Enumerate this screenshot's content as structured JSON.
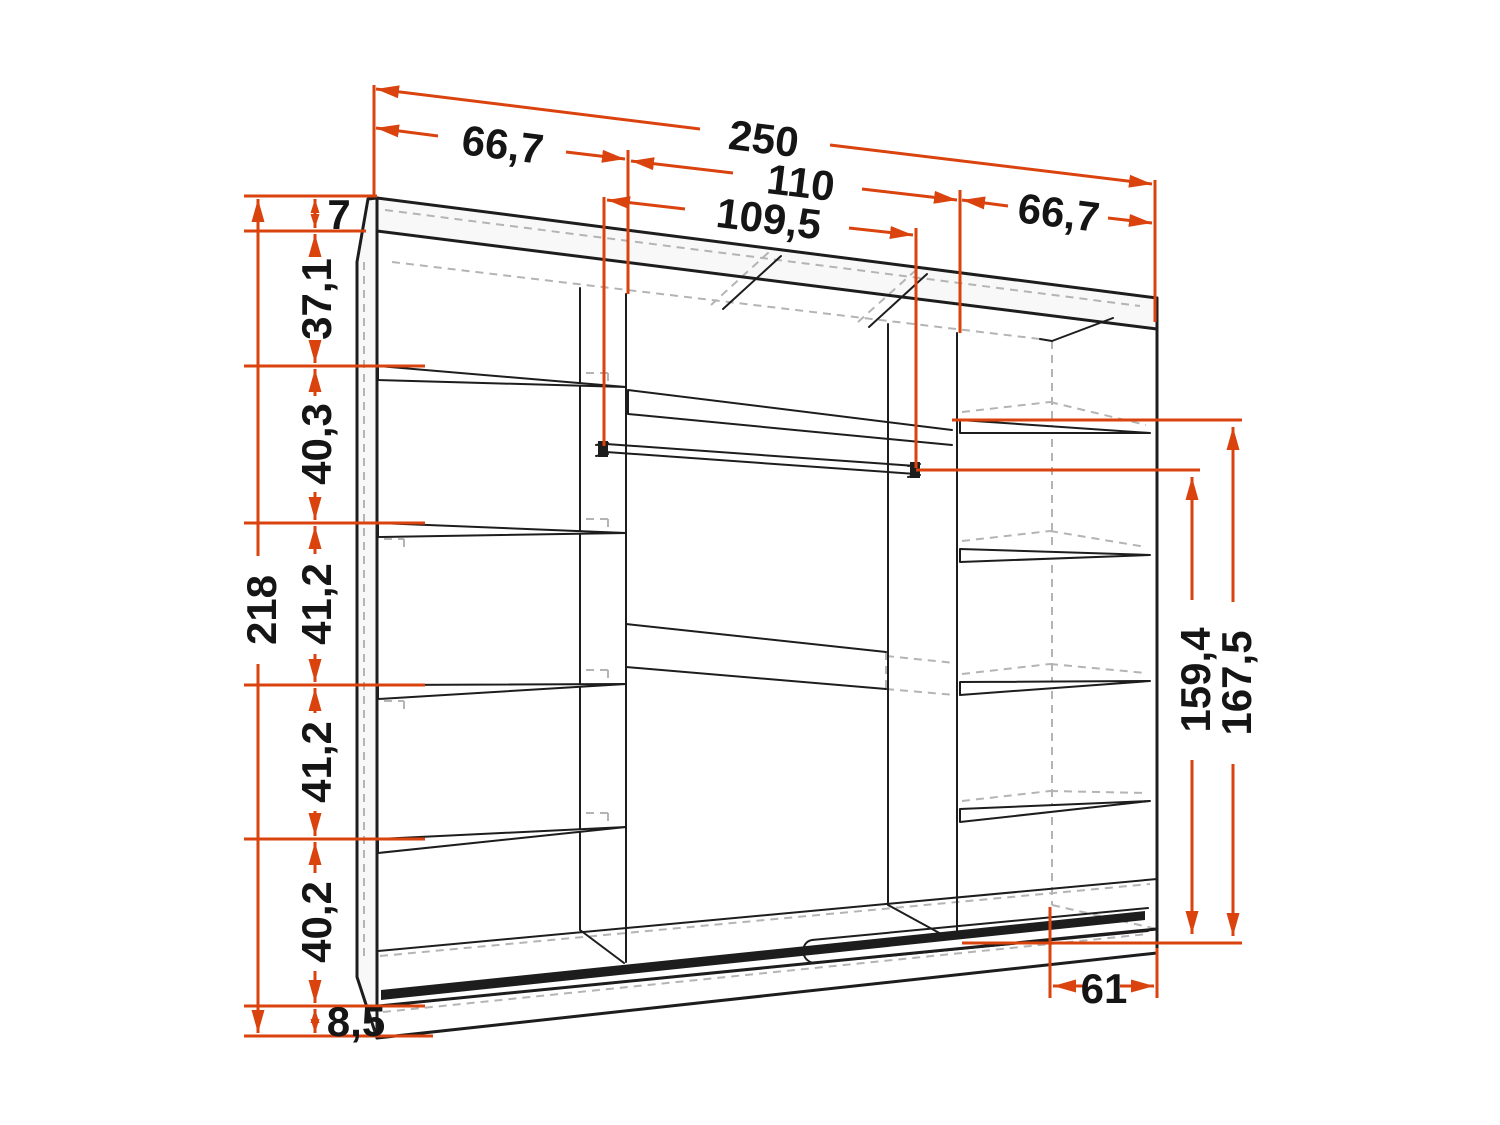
{
  "colors": {
    "dim": "#da420e",
    "line": "#1d1d1d",
    "hidden": "#b4b4b4",
    "text": "#151515",
    "background": "#ffffff"
  },
  "dims": {
    "total_width": "250",
    "left_width": "66,7",
    "middle_width": "110",
    "rail_inner_width": "109,5",
    "right_width": "66,7",
    "total_height": "218",
    "top_rail_height": "7",
    "section_37": "37,1",
    "section_40_3": "40,3",
    "section_41_2a": "41,2",
    "section_41_2b": "41,2",
    "section_40_2": "40,2",
    "plinth_height": "8,5",
    "rail_height": "159,4",
    "shelf_height": "167,5",
    "depth": "61"
  }
}
